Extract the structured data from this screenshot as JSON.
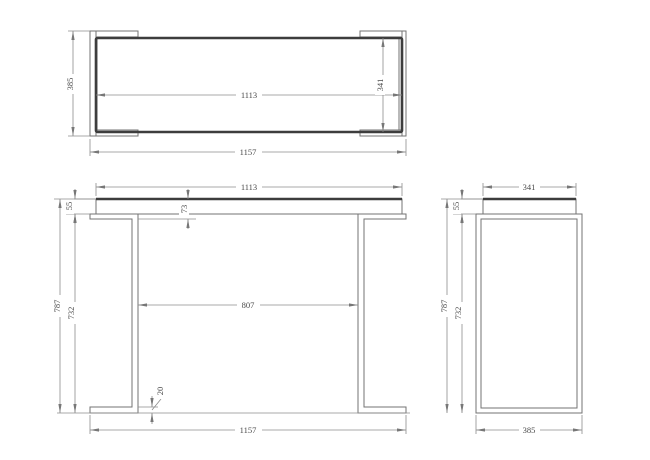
{
  "colors": {
    "line_thin": "#737373",
    "line_thick": "#3d3d3d",
    "dim_line": "#8c8c8c",
    "dim_text": "#4a4a4a",
    "background": "#ffffff"
  },
  "views": {
    "top": {
      "dims": {
        "overall_depth": "385",
        "top_width": "1113",
        "top_depth": "341",
        "overall_width": "1157"
      }
    },
    "front": {
      "dims": {
        "top_width": "1113",
        "top_thickness": "55",
        "top_assembly_drop": "73",
        "overall_height": "787",
        "leg_height": "732",
        "clear_span": "807",
        "foot_thickness": "20",
        "overall_width": "1157"
      }
    },
    "side": {
      "dims": {
        "top_depth": "341",
        "top_thickness": "55",
        "overall_height": "787",
        "leg_height": "732",
        "overall_depth": "385"
      }
    }
  }
}
